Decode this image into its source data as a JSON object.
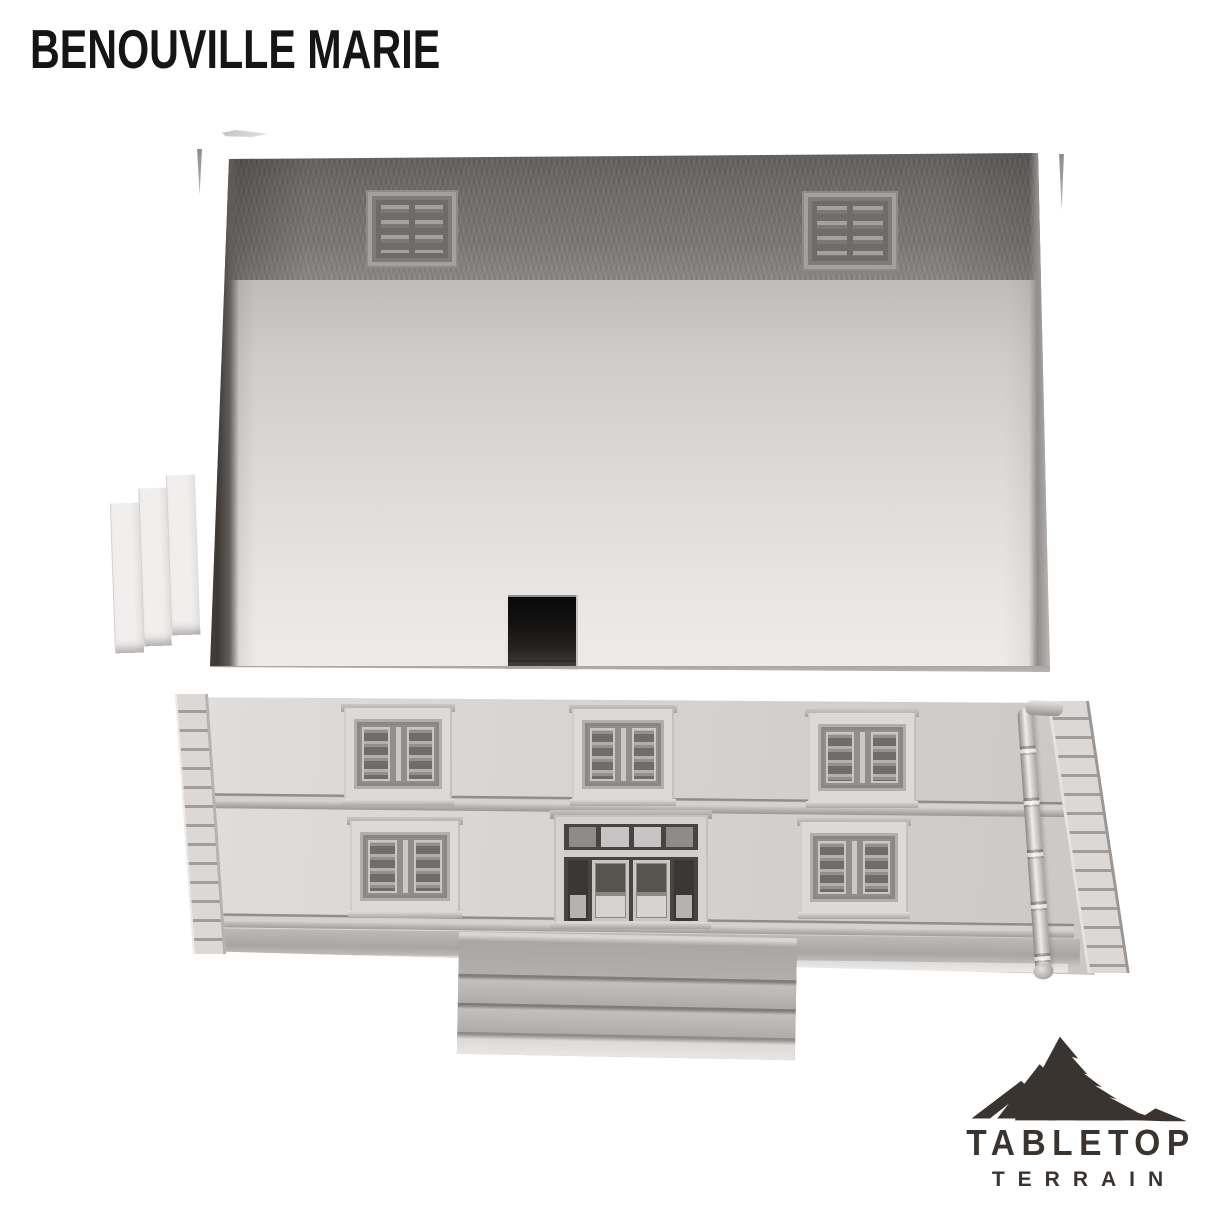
{
  "page": {
    "title": "BENOUVILLE MARIE"
  },
  "logo": {
    "brand": "TABLETOP",
    "subtitle": "TERRAIN",
    "icon": "mountain-range",
    "color": "#3a3430"
  },
  "palette": {
    "paper": "#ffffff",
    "ink": "#161514",
    "logo": "#3a3430",
    "facade": "#d6d3d1",
    "backwall": "#7b7876",
    "floor_light": "#e9e7e6",
    "floor_mid": "#cfcccb",
    "wall_shadow": "#3e3b39",
    "slat_dark": "#6f6c6a",
    "frame_light": "#dcd9d7",
    "step_gray": "#b0adab"
  }
}
